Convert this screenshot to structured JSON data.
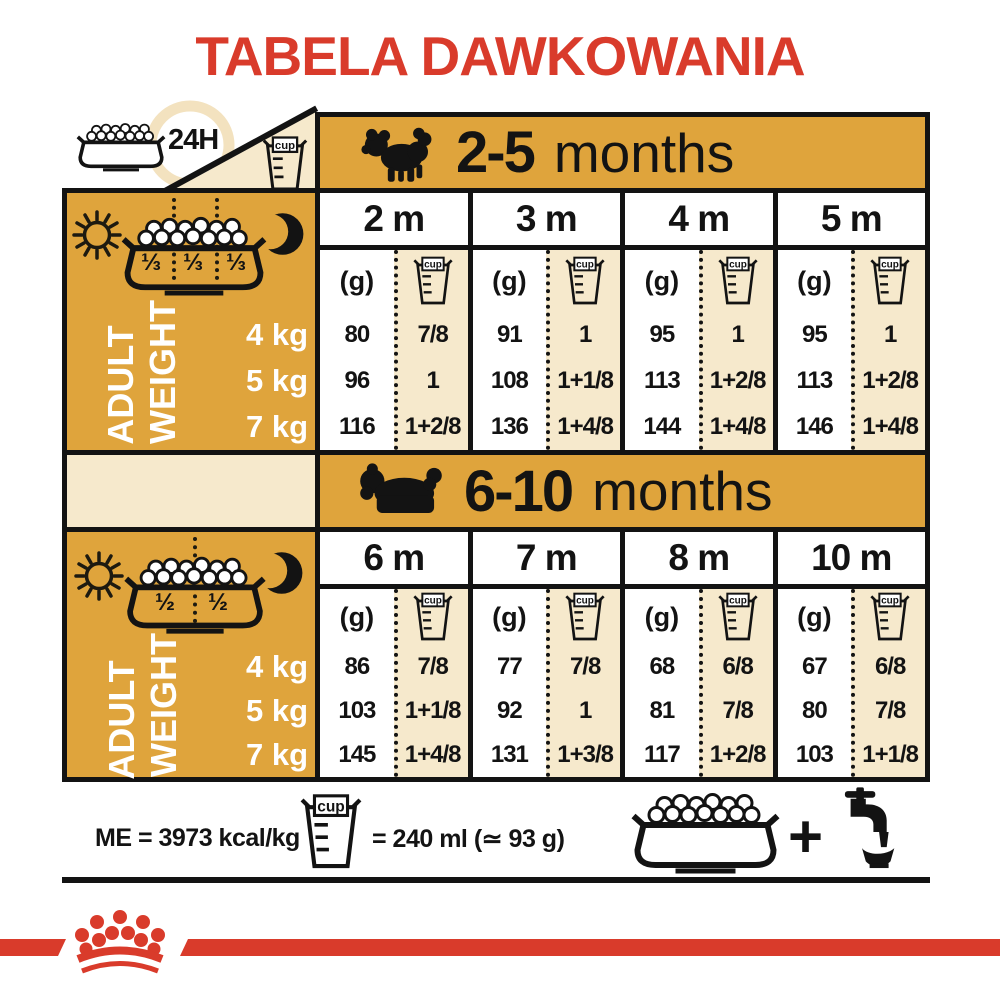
{
  "title": "TABELA DAWKOWANIA",
  "top": {
    "always_label": "24H"
  },
  "labels": {
    "g": "(g)",
    "cup": "cup",
    "adult": "ADULT",
    "weight": "WEIGHT"
  },
  "sections": [
    {
      "age": "2-5",
      "age_unit": "months",
      "bowl_portions": [
        "⅓",
        "⅓",
        "⅓"
      ],
      "weights": [
        "4 kg",
        "5 kg",
        "7 kg"
      ],
      "columns": [
        {
          "month": "2 m",
          "grams": [
            "80",
            "96",
            "116"
          ],
          "cups": [
            "7/8",
            "1",
            "1+2/8"
          ]
        },
        {
          "month": "3 m",
          "grams": [
            "91",
            "108",
            "136"
          ],
          "cups": [
            "1",
            "1+1/8",
            "1+4/8"
          ]
        },
        {
          "month": "4 m",
          "grams": [
            "95",
            "113",
            "144"
          ],
          "cups": [
            "1",
            "1+2/8",
            "1+4/8"
          ]
        },
        {
          "month": "5 m",
          "grams": [
            "95",
            "113",
            "146"
          ],
          "cups": [
            "1",
            "1+2/8",
            "1+4/8"
          ]
        }
      ]
    },
    {
      "age": "6-10",
      "age_unit": "months",
      "bowl_portions": [
        "½",
        "½"
      ],
      "weights": [
        "4 kg",
        "5 kg",
        "7 kg"
      ],
      "columns": [
        {
          "month": "6 m",
          "grams": [
            "86",
            "103",
            "145"
          ],
          "cups": [
            "7/8",
            "1+1/8",
            "1+4/8"
          ]
        },
        {
          "month": "7 m",
          "grams": [
            "77",
            "92",
            "131"
          ],
          "cups": [
            "7/8",
            "1",
            "1+3/8"
          ]
        },
        {
          "month": "8 m",
          "grams": [
            "68",
            "81",
            "117"
          ],
          "cups": [
            "6/8",
            "7/8",
            "1+2/8"
          ]
        },
        {
          "month": "10 m",
          "grams": [
            "67",
            "80",
            "103"
          ],
          "cups": [
            "6/8",
            "7/8",
            "1+1/8"
          ]
        }
      ]
    }
  ],
  "footer": {
    "me": "ME = 3973 kcal/kg",
    "cup_equiv": "= 240 ml (≃ 93 g)",
    "plus": "+"
  },
  "colors": {
    "gold": "#DFA43C",
    "cream": "#F6E9CC",
    "red": "#D93B2B",
    "black": "#131313",
    "pale_ring": "#F3E2BF"
  }
}
